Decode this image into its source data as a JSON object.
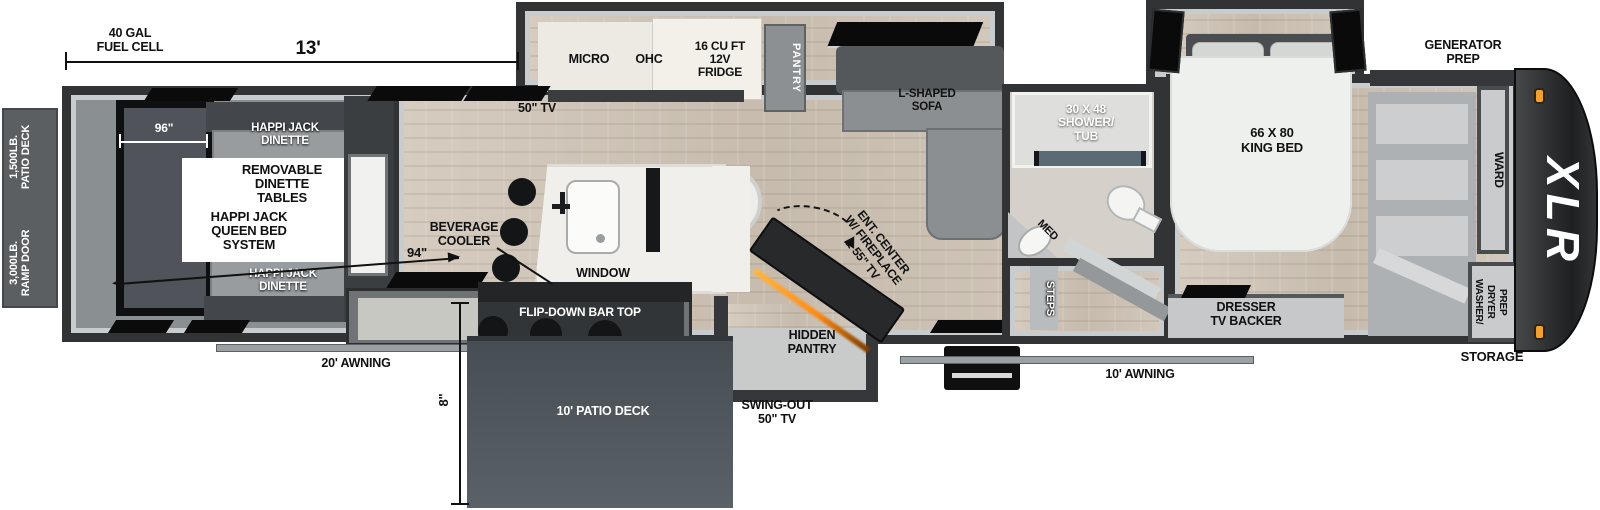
{
  "title": "XLR toy hauler fifth wheel floor plan",
  "colors": {
    "wall": "#313335",
    "wood_floor": "#cec4b7",
    "garage_floor": "#8a8f92",
    "deck": "#565d62",
    "accent_orange": "#f0a12f",
    "shower_glass": "#5a6b75",
    "fireplace_glow": "#ff9a1f"
  },
  "dimensions": {
    "garage_length": "13'",
    "garage_width": "96\"",
    "garage_diagonal": "94\"",
    "deck_depth": "8\""
  },
  "exterior": {
    "fuel_cell": "40 GAL\nFUEL CELL",
    "patio_deck_rating": "1,500LB.\nPATIO DECK",
    "ramp_door_rating": "3,000LB.\nRAMP DOOR",
    "awning_rear": "20' AWNING",
    "awning_entry": "10' AWNING",
    "patio_deck": "10' PATIO DECK",
    "swing_out_tv": "SWING-OUT\n50\" TV",
    "generator_prep": "GENERATOR\nPREP",
    "storage": "STORAGE",
    "brand": "XLR"
  },
  "garage": {
    "dinette_top": "HAPPI JACK\nDINETTE",
    "dinette_bottom": "HAPPI JACK\nDINETTE",
    "removable_tables_note": "REMOVABLE\nDINETTE\nTABLES",
    "queen_bed_note": "HAPPI JACK\nQUEEN BED\nSYSTEM",
    "tv": "50\" TV"
  },
  "kitchen": {
    "micro": "MICRO",
    "ohc": "OHC",
    "fridge": "16 CU FT\n12V\nFRIDGE",
    "pantry": "PANTRY",
    "beverage_cooler": "BEVERAGE\nCOOLER",
    "window": "WINDOW",
    "flip_down_bar": "FLIP-DOWN BAR TOP",
    "hidden_pantry": "HIDDEN\nPANTRY"
  },
  "living": {
    "sofa": "L-SHAPED\nSOFA",
    "entertainment_center": "ENT. CENTER\nW/ FIREPLACE\n& 55\" TV"
  },
  "bathroom": {
    "shower": "30 X 48\nSHOWER/\nTUB",
    "medicine_cabinet": "MED",
    "steps": "STEPS"
  },
  "bedroom": {
    "king_bed": "66 X 80\nKING BED",
    "dresser": "DRESSER\nTV BACKER",
    "wardrobe": "WARD",
    "washer_dryer": "WASHER/\nDRYER\nPREP"
  }
}
